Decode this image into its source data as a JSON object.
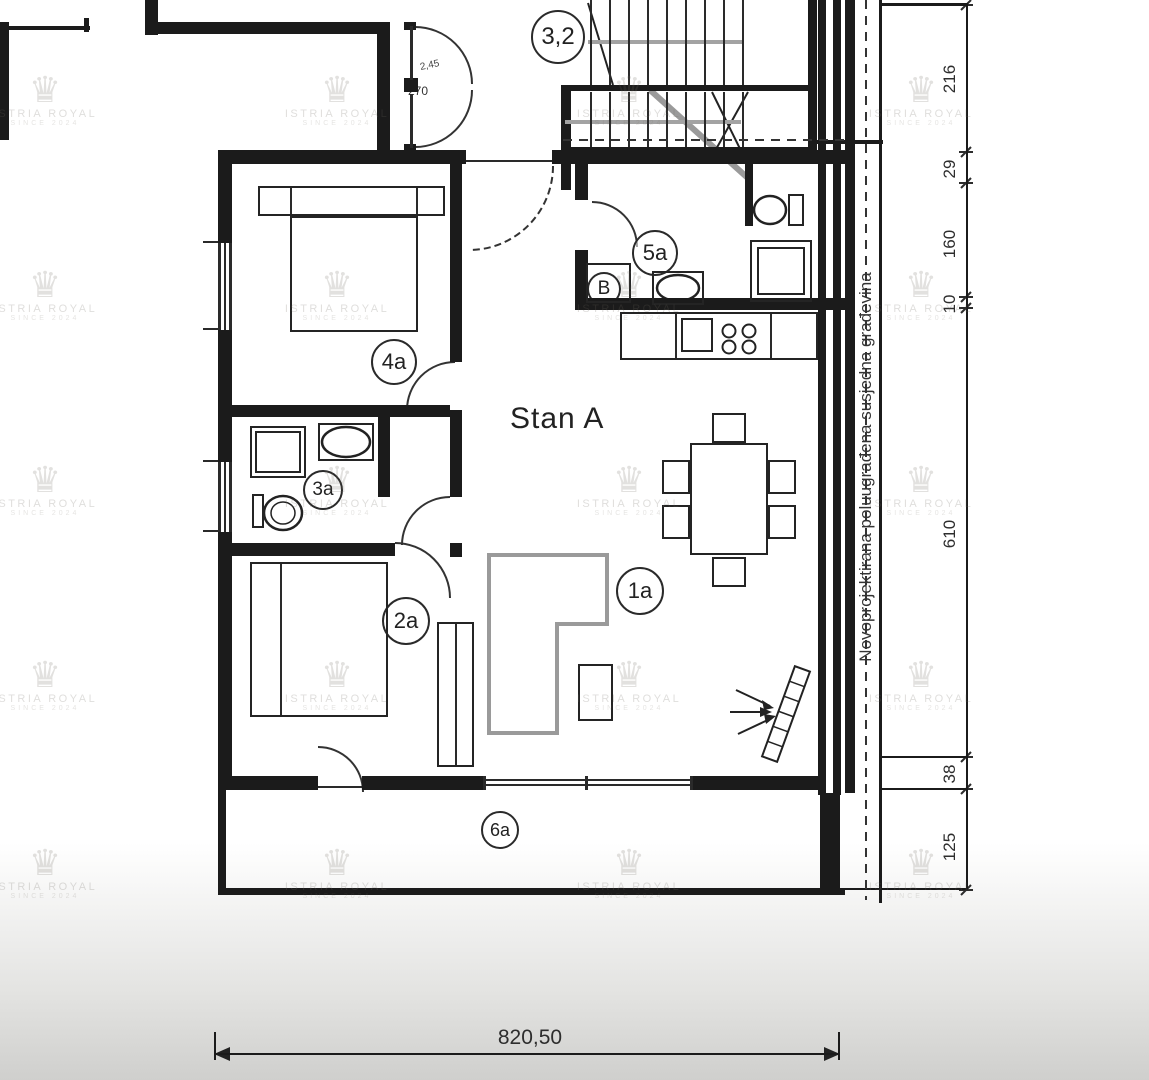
{
  "title": "Stan A",
  "labels": {
    "stairwell": "3,2",
    "bath_upper": "5a",
    "boiler": "B",
    "bedroom1": "4a",
    "bathroom": "3a",
    "bedroom2": "2a",
    "living": "1a",
    "terrace": "6a"
  },
  "annotations": {
    "door_width": "2,45",
    "door_height": "270",
    "wall_mark": "2",
    "side_text": "Novoprojektirana poluugrađena susjedna građevina"
  },
  "dimensions": {
    "right": [
      "216",
      "29",
      "160",
      "10",
      "610",
      "38",
      "125"
    ],
    "bottom_total": "820,50"
  },
  "watermark": {
    "crown_icon": "♛",
    "brand": "ISTRIA ROYAL",
    "since": "SINCE 2024"
  }
}
